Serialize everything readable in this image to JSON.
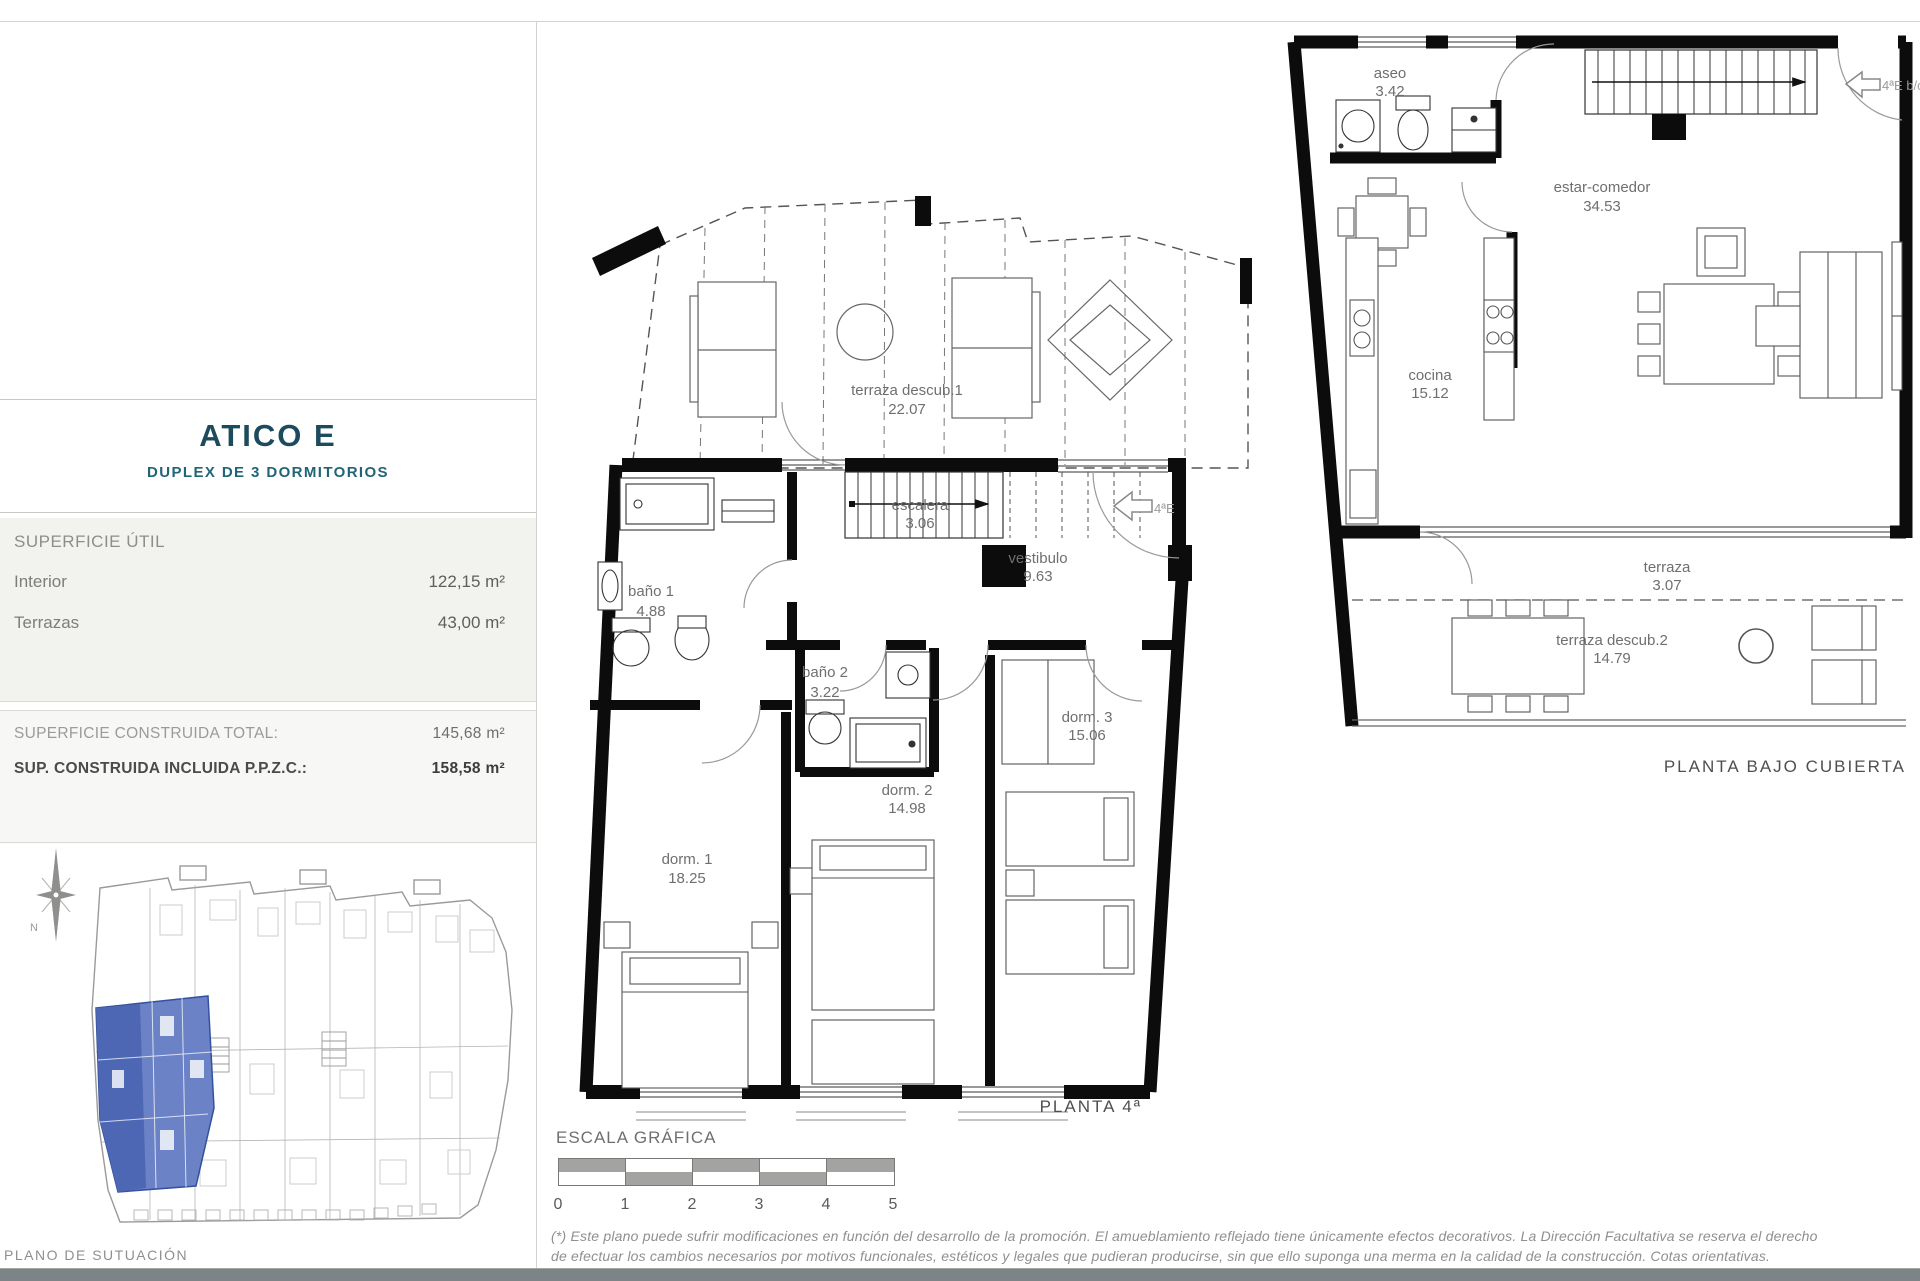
{
  "colors": {
    "accent": "#1d4b5e",
    "teal": "#206577",
    "highlight_blue": "#6b82c6",
    "highlight_blue_dark": "#4d67b4",
    "panel_gray": "#f2f2ef",
    "footer_bar": "#7c8488"
  },
  "sidebar": {
    "title": "ATICO E",
    "subtitle": "DUPLEX DE 3 DORMITORIOS",
    "superficie_util": {
      "header": "SUPERFICIE ÚTIL",
      "rows": [
        {
          "label": "Interior",
          "value": "122,15 m²"
        },
        {
          "label": "Terrazas",
          "value": "43,00 m²"
        }
      ]
    },
    "totals": {
      "row1_label": "SUPERFICIE CONSTRUIDA TOTAL:",
      "row1_value": "145,68 m²",
      "row2_label": "SUP. CONSTRUIDA INCLUIDA P.P.Z.C.:",
      "row2_value": "158,58 m²"
    },
    "compass": "N",
    "site_caption": "PLANO DE SUTUACIÓN"
  },
  "planta4": {
    "title": "PLANTA 4ª",
    "door_marker": "4ªE",
    "rooms": {
      "terraza": {
        "name": "terraza descub.1",
        "area": "22.07"
      },
      "escalera": {
        "name": "escalera",
        "area": "3.06"
      },
      "vestibulo": {
        "name": "vestibulo",
        "area": "9.63"
      },
      "banyo1": {
        "name": "baño 1",
        "area": "4.88"
      },
      "banyo2": {
        "name": "baño 2",
        "area": "3.22"
      },
      "dorm1": {
        "name": "dorm. 1",
        "area": "18.25"
      },
      "dorm2": {
        "name": "dorm. 2",
        "area": "14.98"
      },
      "dorm3": {
        "name": "dorm. 3",
        "area": "15.06"
      }
    }
  },
  "plantaBajoCubierta": {
    "title": "PLANTA BAJO CUBIERTA",
    "door_marker": "4ªE b/c",
    "rooms": {
      "aseo": {
        "name": "aseo",
        "area": "3.42"
      },
      "estar": {
        "name": "estar-comedor",
        "area": "34.53"
      },
      "cocina": {
        "name": "cocina",
        "area": "15.12"
      },
      "terraza": {
        "name": "terraza",
        "area": "3.07"
      },
      "terraza2": {
        "name": "terraza descub.2",
        "area": "14.79"
      }
    }
  },
  "escala": {
    "title": "ESCALA GRÁFICA",
    "ticks": [
      "0",
      "1",
      "2",
      "3",
      "4",
      "5"
    ]
  },
  "disclaimer": {
    "line1": "(*) Este plano puede sufrir modificaciones en función del desarrollo de la promoción. El amueblamiento reflejado tiene únicamente efectos decorativos. La Dirección Facultativa se reserva el derecho",
    "line2": "de efectuar los cambios necesarios por motivos funcionales, estéticos y legales que pudieran producirse, sin que ello suponga una merma en la calidad de la construcción. Cotas orientativas."
  }
}
